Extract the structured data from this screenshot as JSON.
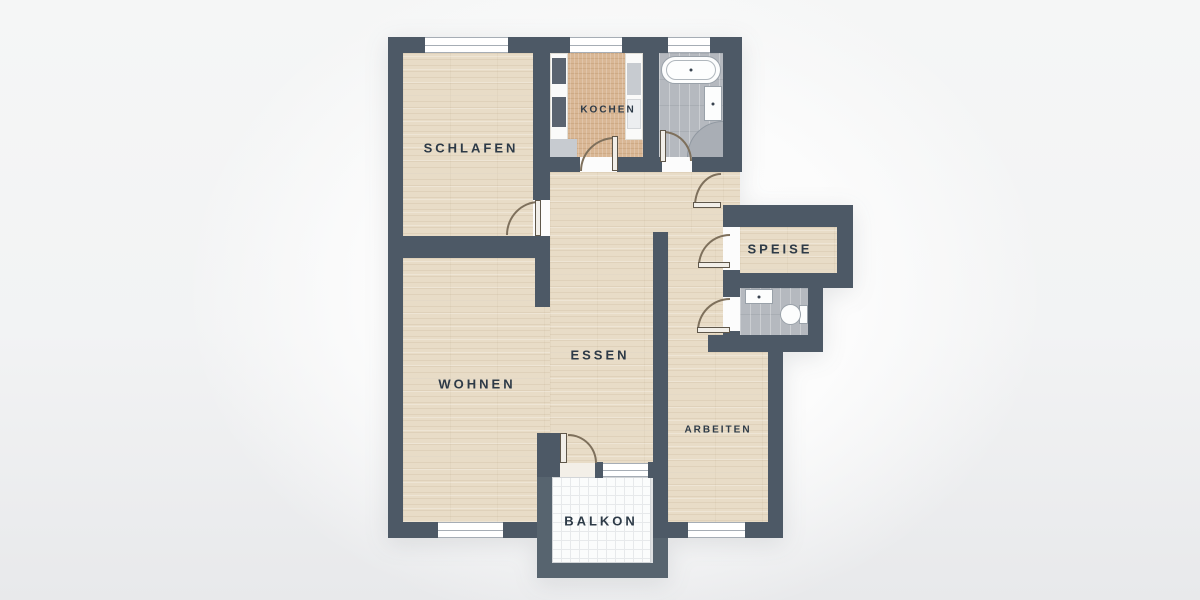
{
  "plan": {
    "rooms": {
      "schlafen": {
        "label": "SCHLAFEN"
      },
      "kochen": {
        "label": "KOCHEN"
      },
      "wohnen": {
        "label": "WOHNEN"
      },
      "essen": {
        "label": "ESSEN"
      },
      "arbeiten": {
        "label": "ARBEITEN"
      },
      "speise": {
        "label": "SPEISE"
      },
      "balkon": {
        "label": "BALKON"
      }
    },
    "fixtures": [
      "bathtub",
      "washbasin",
      "corner-shower",
      "toilet",
      "kitchen-counters"
    ],
    "colors": {
      "wall": "#4d5966",
      "balcony_wall": "#57646f",
      "wood_floor": "#e8dcc7",
      "kitchen_floor": "#d9b795",
      "tile_floor": "#b5b9bf",
      "balcony_floor": "#fbfcfc",
      "door_arc": "#7e705c",
      "label_text": "#2d3a47",
      "background": "#f2f3f4"
    }
  }
}
